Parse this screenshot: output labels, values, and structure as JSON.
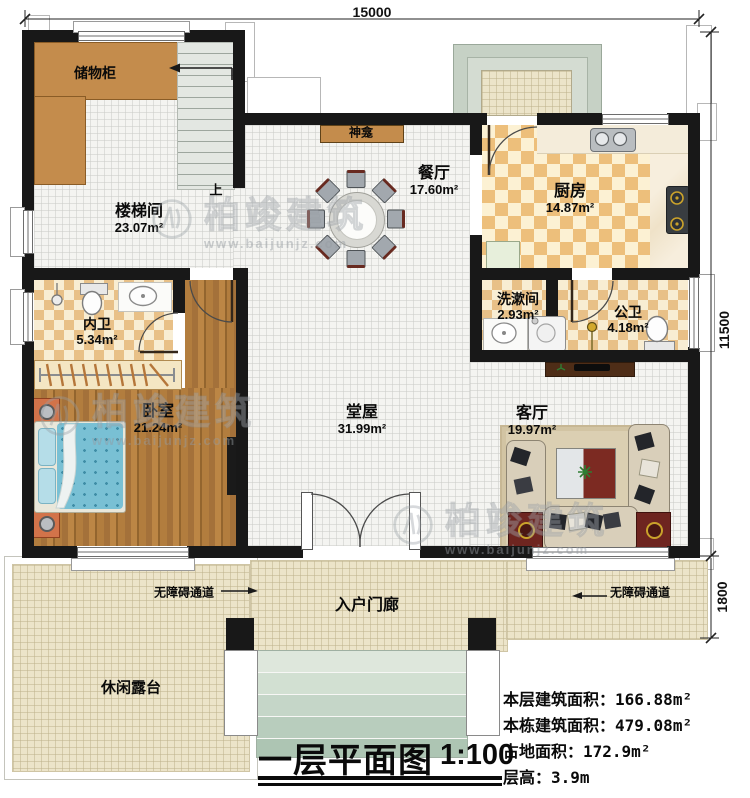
{
  "plan": {
    "title": "一层平面图",
    "scale": "1:100",
    "dim_top": "15000",
    "dim_right": "11500",
    "dim_porch": "1800"
  },
  "rooms": {
    "closet": {
      "name": "储物柜"
    },
    "stairwell": {
      "name": "楼梯间",
      "area": "23.07m²"
    },
    "shrine": {
      "name": "神龛"
    },
    "dining": {
      "name": "餐厅",
      "area": "17.60m²"
    },
    "kitchen": {
      "name": "厨房",
      "area": "14.87m²"
    },
    "washroom": {
      "name": "洗漱间",
      "area": "2.93m²"
    },
    "public_wc": {
      "name": "公卫",
      "area": "4.18m²"
    },
    "ensuite_wc": {
      "name": "内卫",
      "area": "5.34m²"
    },
    "bedroom": {
      "name": "卧室",
      "area": "21.24m²"
    },
    "hall": {
      "name": "堂屋",
      "area": "31.99m²"
    },
    "living": {
      "name": "客厅",
      "area": "19.97m²"
    },
    "porch": {
      "name": "入户门廊"
    },
    "terrace": {
      "name": "休闲露台"
    }
  },
  "annotations": {
    "stairs_up": "上",
    "ramp_left": "无障碍通道",
    "ramp_right": "无障碍通道"
  },
  "stats": {
    "rows": [
      {
        "label": "本层建筑面积：",
        "value": "166.88m²"
      },
      {
        "label": "本栋建筑面积：",
        "value": "479.08m²"
      },
      {
        "label": "占地面积：",
        "value": "172.9m²"
      },
      {
        "label": "层高：",
        "value": "3.9m"
      }
    ]
  },
  "watermark": {
    "brand": "柏竣建筑",
    "site": "www.baijunjz.com"
  },
  "colors": {
    "wall": "#181818",
    "wood": "#a9763c",
    "cabinet": "#c48c4c",
    "checker": "#edbf7b",
    "accent_red": "#6e2520",
    "step_green": "#c5d6c8"
  }
}
